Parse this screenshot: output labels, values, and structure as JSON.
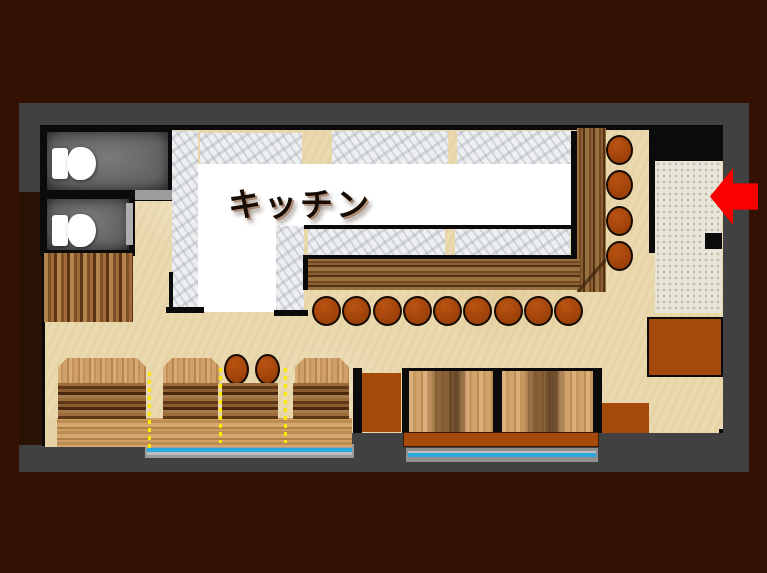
{
  "plan": {
    "kitchen_label": "キッチン",
    "colors": {
      "background": "#331103",
      "wall_frame": "#414141",
      "floor": "#ead9ae",
      "entrance_floor": "#e8e4d8",
      "accent_orange": "#a64a0c",
      "arrow_red": "#fb0000",
      "door_blue": "#2aa9e0",
      "divider_yellow": "#ffe800"
    },
    "fixtures": {
      "toilets": 2,
      "counter_stools_bottom": 9,
      "counter_stools_right": 4,
      "floor_stools": 2,
      "booth_sections": 4,
      "low_tables": 2,
      "entrance_doors": 2
    },
    "icons": [
      "toilet-icon",
      "left-arrow-icon"
    ]
  }
}
